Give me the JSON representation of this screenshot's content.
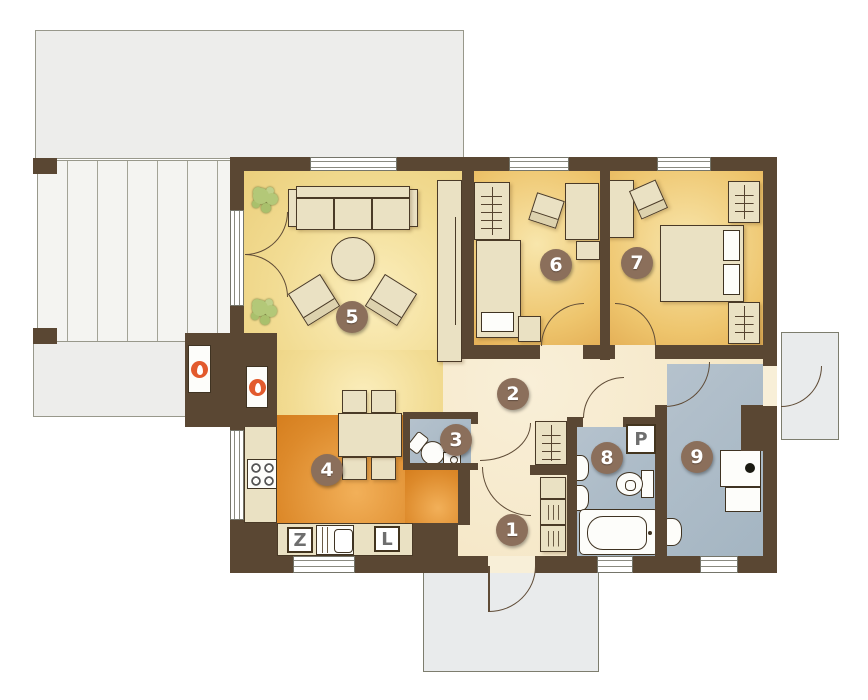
{
  "plan": {
    "rooms": [
      {
        "number": "1"
      },
      {
        "number": "2"
      },
      {
        "number": "3"
      },
      {
        "number": "4"
      },
      {
        "number": "5"
      },
      {
        "number": "6"
      },
      {
        "number": "7"
      },
      {
        "number": "8"
      },
      {
        "number": "9"
      }
    ],
    "markers": {
      "sink": "Z",
      "fridge": "L",
      "washer": "P"
    },
    "icons": {
      "fireplace": "flame-badge",
      "wardrobe": "hanger-rail",
      "shelf": "slat-lines",
      "plant": "leaf-cluster"
    },
    "colors": {
      "wall": "#5a4733",
      "living_floor": "#f2dc93",
      "bedroom_floor": "#eec56d",
      "kitchen_floor": "#dd8a2b",
      "hall_floor": "#f4e7c7",
      "wet_room_floor": "#aabbc7",
      "terrace": "#ededeb",
      "label_circle": "#8b6f5b",
      "flame_badge": "#e25a2d",
      "furniture": "#eae1c3",
      "plant": "#b3c878"
    }
  }
}
